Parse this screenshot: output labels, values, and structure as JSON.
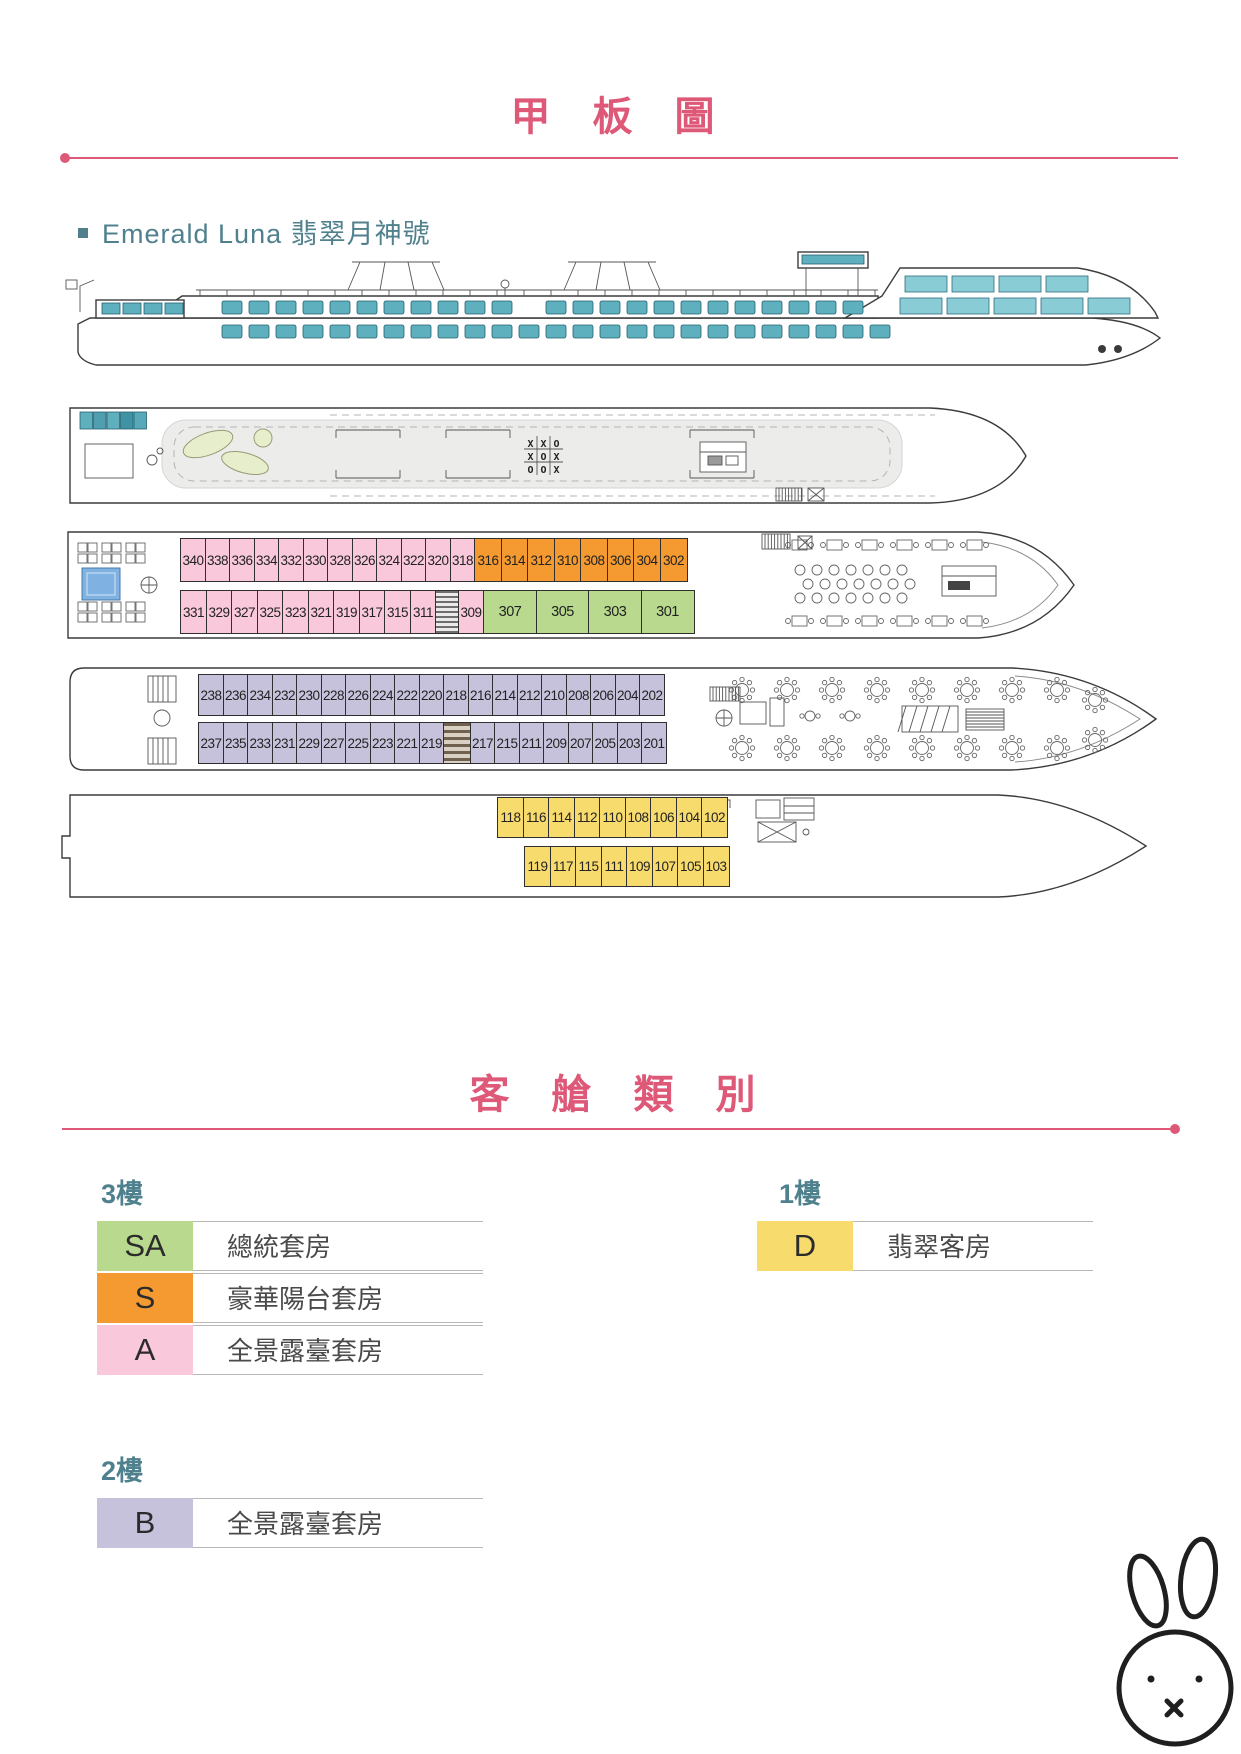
{
  "header": {
    "title": "甲 板 圖"
  },
  "ship": {
    "name": "Emerald Luna 翡翠月神號"
  },
  "sun_deck": {
    "chess": [
      "X",
      "X",
      "O",
      "X",
      "O",
      "X",
      "O",
      "O",
      "X"
    ]
  },
  "decks": {
    "deck3_top": [
      {
        "n": "340",
        "t": "A"
      },
      {
        "n": "338",
        "t": "A"
      },
      {
        "n": "336",
        "t": "A"
      },
      {
        "n": "334",
        "t": "A"
      },
      {
        "n": "332",
        "t": "A"
      },
      {
        "n": "330",
        "t": "A"
      },
      {
        "n": "328",
        "t": "A"
      },
      {
        "n": "326",
        "t": "A"
      },
      {
        "n": "324",
        "t": "A"
      },
      {
        "n": "322",
        "t": "A"
      },
      {
        "n": "320",
        "t": "A"
      },
      {
        "n": "318",
        "t": "A"
      },
      {
        "n": "316",
        "t": "S"
      },
      {
        "n": "314",
        "t": "S"
      },
      {
        "n": "312",
        "t": "S"
      },
      {
        "n": "310",
        "t": "S"
      },
      {
        "n": "308",
        "t": "S"
      },
      {
        "n": "306",
        "t": "S"
      },
      {
        "n": "304",
        "t": "S"
      },
      {
        "n": "302",
        "t": "S"
      }
    ],
    "deck3_bottom": [
      {
        "n": "331",
        "t": "A"
      },
      {
        "n": "329",
        "t": "A"
      },
      {
        "n": "327",
        "t": "A"
      },
      {
        "n": "325",
        "t": "A"
      },
      {
        "n": "323",
        "t": "A"
      },
      {
        "n": "321",
        "t": "A"
      },
      {
        "n": "319",
        "t": "A"
      },
      {
        "n": "317",
        "t": "A"
      },
      {
        "n": "315",
        "t": "A"
      },
      {
        "n": "311",
        "t": "A"
      },
      {
        "n": "",
        "t": "stairs"
      },
      {
        "n": "309",
        "t": "A"
      },
      {
        "n": "307",
        "t": "SA"
      },
      {
        "n": "305",
        "t": "SA"
      },
      {
        "n": "303",
        "t": "SA"
      },
      {
        "n": "301",
        "t": "SA"
      }
    ],
    "deck2_top": [
      {
        "n": "238",
        "t": "B"
      },
      {
        "n": "236",
        "t": "B"
      },
      {
        "n": "234",
        "t": "B"
      },
      {
        "n": "232",
        "t": "B"
      },
      {
        "n": "230",
        "t": "B"
      },
      {
        "n": "228",
        "t": "B"
      },
      {
        "n": "226",
        "t": "B"
      },
      {
        "n": "224",
        "t": "B"
      },
      {
        "n": "222",
        "t": "B"
      },
      {
        "n": "220",
        "t": "B"
      },
      {
        "n": "218",
        "t": "B"
      },
      {
        "n": "216",
        "t": "B"
      },
      {
        "n": "214",
        "t": "B"
      },
      {
        "n": "212",
        "t": "B"
      },
      {
        "n": "210",
        "t": "B"
      },
      {
        "n": "208",
        "t": "B"
      },
      {
        "n": "206",
        "t": "B"
      },
      {
        "n": "204",
        "t": "B"
      },
      {
        "n": "202",
        "t": "B"
      }
    ],
    "deck2_bottom": [
      {
        "n": "237",
        "t": "B"
      },
      {
        "n": "235",
        "t": "B"
      },
      {
        "n": "233",
        "t": "B"
      },
      {
        "n": "231",
        "t": "B"
      },
      {
        "n": "229",
        "t": "B"
      },
      {
        "n": "227",
        "t": "B"
      },
      {
        "n": "225",
        "t": "B"
      },
      {
        "n": "223",
        "t": "B"
      },
      {
        "n": "221",
        "t": "B"
      },
      {
        "n": "219",
        "t": "B"
      },
      {
        "n": "",
        "t": "stairs"
      },
      {
        "n": "217",
        "t": "B"
      },
      {
        "n": "215",
        "t": "B"
      },
      {
        "n": "211",
        "t": "B"
      },
      {
        "n": "209",
        "t": "B"
      },
      {
        "n": "207",
        "t": "B"
      },
      {
        "n": "205",
        "t": "B"
      },
      {
        "n": "203",
        "t": "B"
      },
      {
        "n": "201",
        "t": "B"
      }
    ],
    "deck1_top": [
      {
        "n": "118",
        "t": "D"
      },
      {
        "n": "116",
        "t": "D"
      },
      {
        "n": "114",
        "t": "D"
      },
      {
        "n": "112",
        "t": "D"
      },
      {
        "n": "110",
        "t": "D"
      },
      {
        "n": "108",
        "t": "D"
      },
      {
        "n": "106",
        "t": "D"
      },
      {
        "n": "104",
        "t": "D"
      },
      {
        "n": "102",
        "t": "D"
      }
    ],
    "deck1_bottom": [
      {
        "n": "119",
        "t": "D"
      },
      {
        "n": "117",
        "t": "D"
      },
      {
        "n": "115",
        "t": "D"
      },
      {
        "n": "111",
        "t": "D"
      },
      {
        "n": "109",
        "t": "D"
      },
      {
        "n": "107",
        "t": "D"
      },
      {
        "n": "105",
        "t": "D"
      },
      {
        "n": "103",
        "t": "D"
      }
    ]
  },
  "legend": {
    "title": "客 艙 類 別",
    "colors": {
      "A": "#f9c8da",
      "S": "#f49a31",
      "SA": "#b9da8e",
      "B": "#c6c2dc",
      "D": "#f8db6d"
    },
    "sections": [
      {
        "floor": "3樓",
        "items": [
          {
            "code": "SA",
            "name": "總統套房"
          },
          {
            "code": "S",
            "name": "豪華陽台套房"
          },
          {
            "code": "A",
            "name": "全景露臺套房"
          }
        ]
      },
      {
        "floor": "1樓",
        "items": [
          {
            "code": "D",
            "name": "翡翠客房"
          }
        ]
      },
      {
        "floor": "2樓",
        "items": [
          {
            "code": "B",
            "name": "全景露臺套房"
          }
        ]
      }
    ]
  }
}
